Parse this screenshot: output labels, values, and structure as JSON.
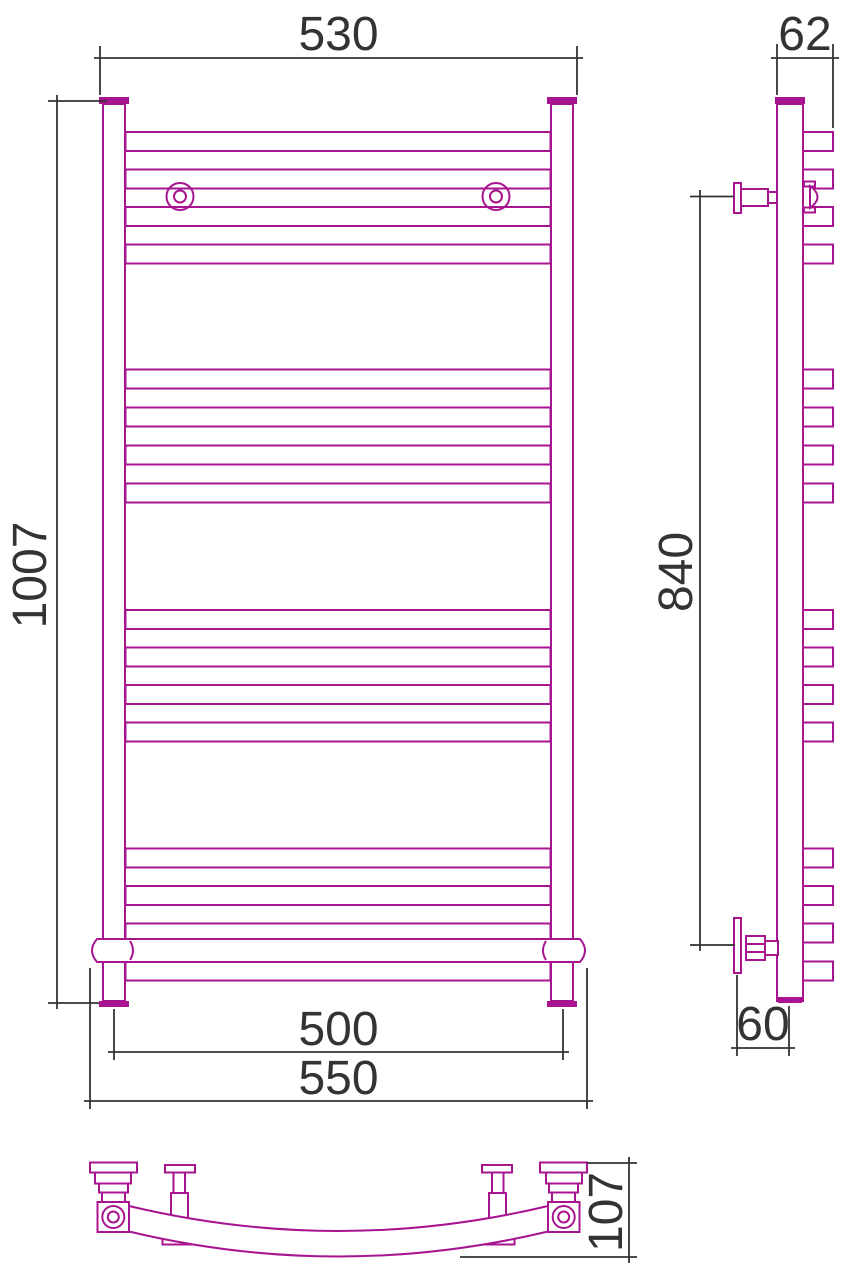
{
  "drawing": {
    "title": "heated-towel-rail-three-view-drawing",
    "dimensions": {
      "front_top_width": {
        "value": "530"
      },
      "side_top_depth": {
        "value": "62"
      },
      "front_total_height": {
        "value": "1007"
      },
      "side_bracket_span": {
        "value": "840"
      },
      "front_axis_width": {
        "value": "500"
      },
      "front_shelf_width": {
        "value": "550"
      },
      "side_wall_offset": {
        "value": "60"
      },
      "bottom_view_depth": {
        "value": "107"
      }
    },
    "structure": {
      "tube_rows_visible": 16,
      "tube_groups": 4,
      "wall_brackets_front": 2
    },
    "colors": {
      "product_line": "#A81490",
      "dimension_line": "#333333",
      "background": "#ffffff"
    }
  }
}
